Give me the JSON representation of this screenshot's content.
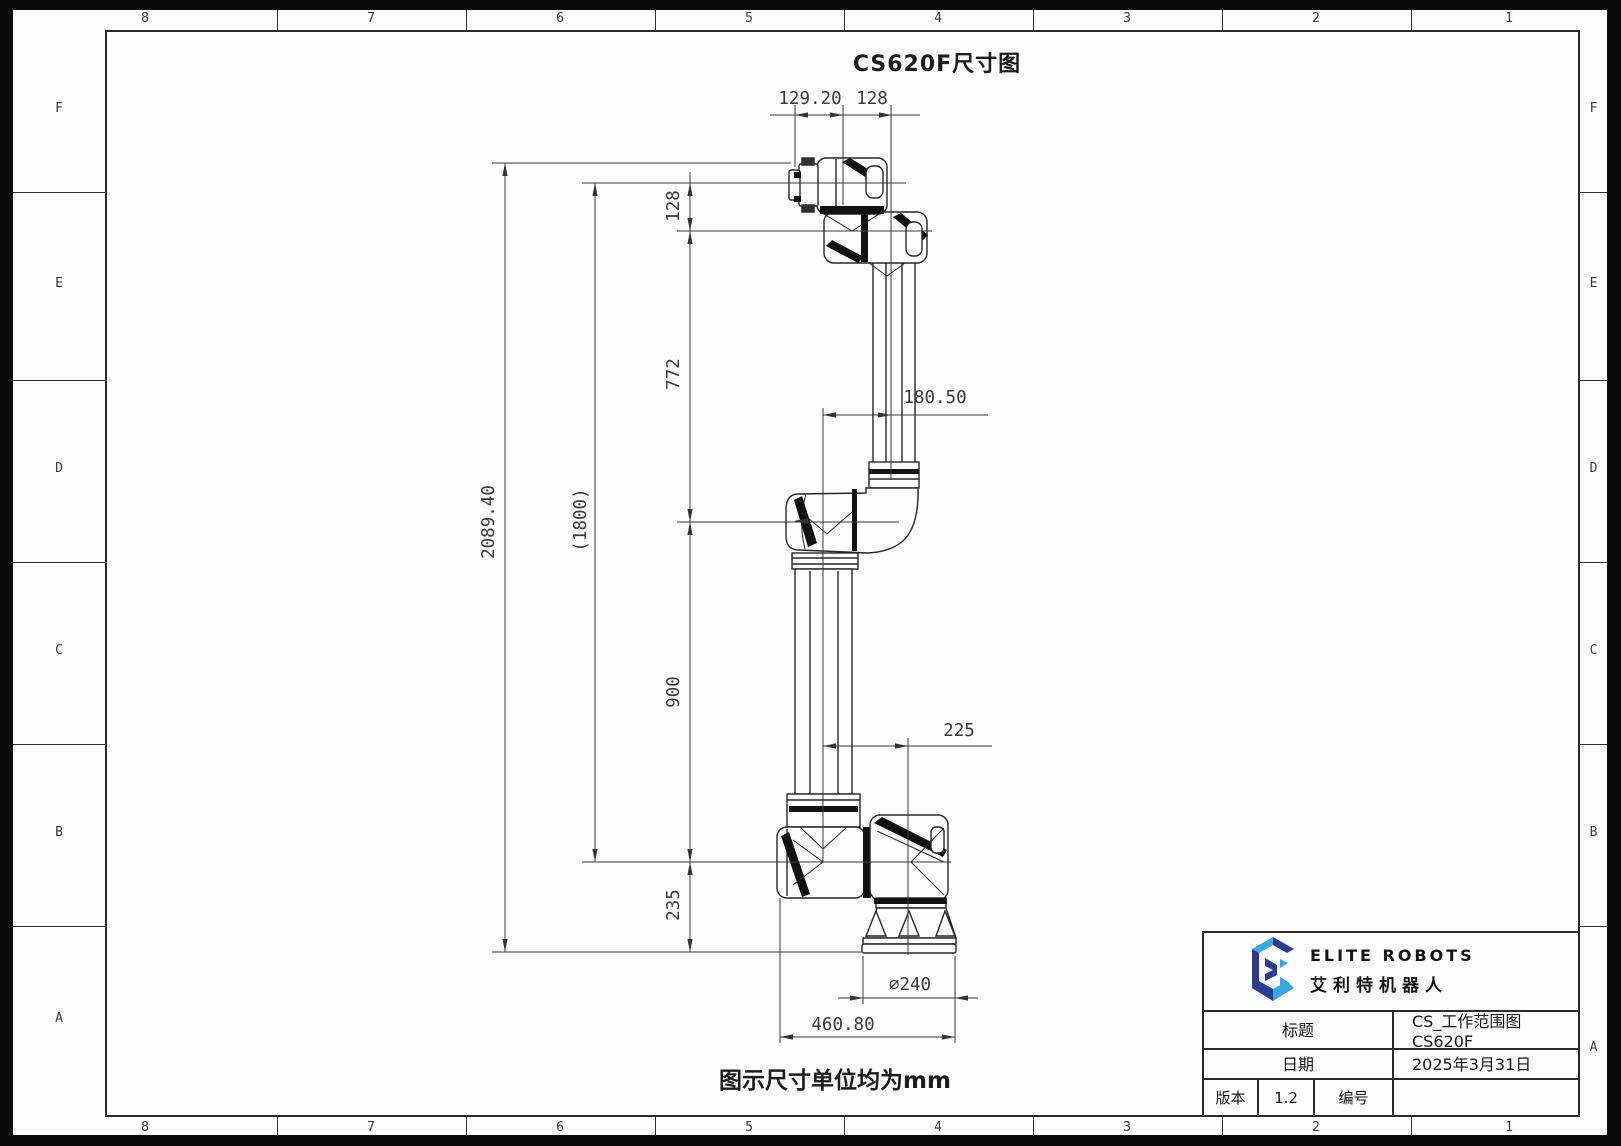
{
  "sheet": {
    "title": "CS620F尺寸图",
    "caption": "图示尺寸单位均为mm",
    "grid": {
      "cols": [
        "8",
        "7",
        "6",
        "5",
        "4",
        "3",
        "2",
        "1"
      ],
      "rows": [
        "F",
        "E",
        "D",
        "C",
        "B",
        "A"
      ]
    }
  },
  "dims": {
    "d129_20": "129.20",
    "d128_top": "128",
    "d128_side": "128",
    "d772": "772",
    "d2089_40": "2089.40",
    "d1800": "(1800)",
    "d180_50": "180.50",
    "d900": "900",
    "d225": "225",
    "d235": "235",
    "d240": "∅240",
    "d460_80": "460.80"
  },
  "title_block": {
    "brand_en": "ELITE ROBOTS",
    "brand_cn": "艾利特机器人",
    "title_label": "标题",
    "title_value": "CS_工作范围图 CS620F",
    "date_label": "日期",
    "date_value": "2025年3月31日",
    "version_label": "版本",
    "version_value": "1.2",
    "number_label": "编号",
    "number_value": ""
  },
  "colors": {
    "logo_navy": "#2c3a94",
    "logo_blue": "#37a9e0",
    "line": "#2a2a2a",
    "sheet": "#fcfcfc",
    "frame": "#0a0a0a"
  }
}
